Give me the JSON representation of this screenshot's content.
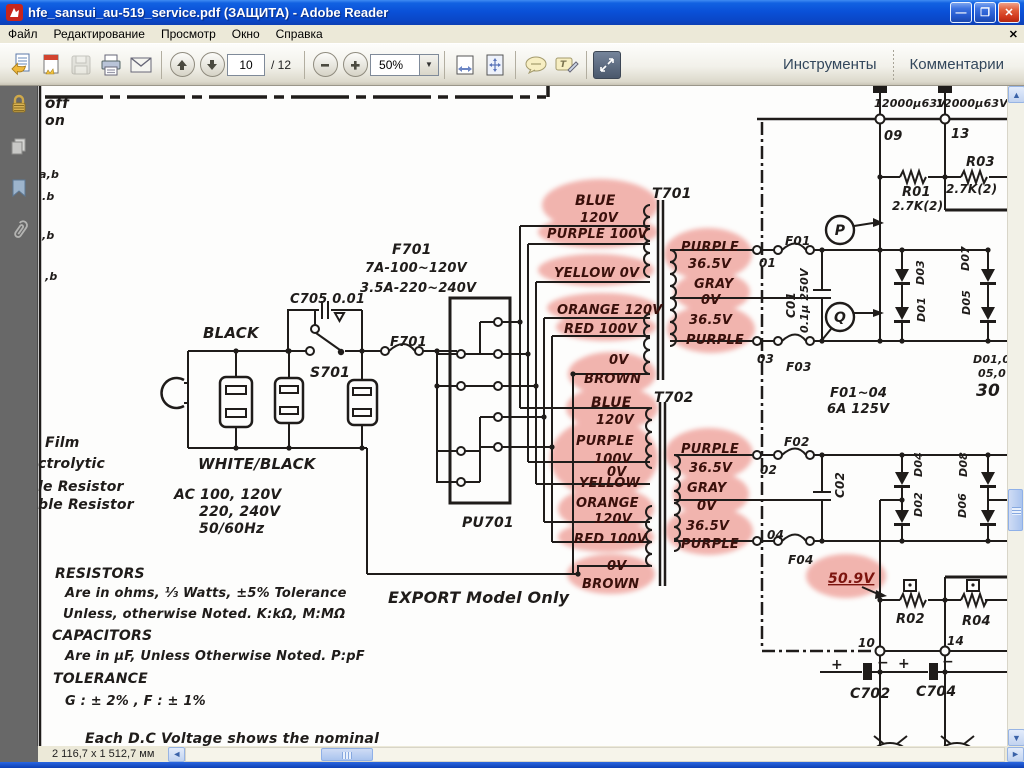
{
  "window": {
    "title": "hfe_sansui_au-519_service.pdf (ЗАЩИТА) - Adobe Reader",
    "minimize_glyph": "—",
    "restore_glyph": "❐",
    "close_glyph": "✕"
  },
  "menu": {
    "items": [
      "Файл",
      "Редактирование",
      "Просмотр",
      "Окно",
      "Справка"
    ],
    "close_glyph": "✕"
  },
  "toolbar": {
    "icons": [
      "open-file",
      "create-pdf",
      "save",
      "print",
      "email",
      "previous-page",
      "next-page",
      "zoom-out",
      "zoom-in",
      "fit-width",
      "fit-page",
      "comment-bubble",
      "text-callout",
      "fullscreen"
    ],
    "page_current": "10",
    "page_total": "/ 12",
    "zoom_value": "50%",
    "zoom_dropdown_glyph": "▼",
    "tools_label": "Инструменты",
    "comments_label": "Комментарии"
  },
  "sidebar": {
    "icons": [
      "lock",
      "pages",
      "bookmark",
      "paperclip"
    ]
  },
  "statusbar": {
    "doc_size": "2 116,7 x 1 512,7 мм",
    "left_glyph": "◄",
    "right_glyph": "►",
    "up_glyph": "▲",
    "down_glyph": "▼"
  },
  "schematic": {
    "highlight_color": "#efa29b",
    "labels": [
      {
        "t": "off",
        "x": 7,
        "y": 22,
        "s": 15
      },
      {
        "t": "on",
        "x": 7,
        "y": 39,
        "s": 14
      },
      {
        "t": "a,b",
        "x": 1,
        "y": 92,
        "s": 11
      },
      {
        "t": ".b",
        "x": 4,
        "y": 114,
        "s": 11
      },
      {
        "t": ",b",
        "x": 4,
        "y": 153,
        "s": 11
      },
      {
        "t": ",b",
        "x": 7,
        "y": 194,
        "s": 11
      },
      {
        "t": "BLACK",
        "x": 165,
        "y": 252,
        "s": 15
      },
      {
        "t": "C705 0.01",
        "x": 252,
        "y": 217,
        "s": 13
      },
      {
        "t": "S701",
        "x": 272,
        "y": 291,
        "s": 14
      },
      {
        "t": "F701",
        "x": 354,
        "y": 168,
        "s": 14
      },
      {
        "t": "7A-100~120V",
        "x": 327,
        "y": 186,
        "s": 13
      },
      {
        "t": "3.5A-220~240V",
        "x": 322,
        "y": 206,
        "s": 13
      },
      {
        "t": "F701",
        "x": 352,
        "y": 260,
        "s": 13
      },
      {
        "t": "PU701",
        "x": 424,
        "y": 441,
        "s": 14
      },
      {
        "t": "EXPORT Model Only",
        "x": 350,
        "y": 517,
        "s": 16
      },
      {
        "t": "WHITE/BLACK",
        "x": 160,
        "y": 383,
        "s": 15
      },
      {
        "t": "AC 100, 120V",
        "x": 136,
        "y": 413,
        "s": 14
      },
      {
        "t": "220, 240V",
        "x": 161,
        "y": 430,
        "s": 14
      },
      {
        "t": "50/60Hz",
        "x": 161,
        "y": 447,
        "s": 14
      },
      {
        "t": "T701",
        "x": 614,
        "y": 112,
        "s": 14
      },
      {
        "t": "T702",
        "x": 616,
        "y": 316,
        "s": 14
      },
      {
        "t": "12000μ63V",
        "x": 836,
        "y": 21,
        "s": 11
      },
      {
        "t": "12000μ63V",
        "x": 898,
        "y": 21,
        "s": 11
      },
      {
        "t": "09",
        "x": 846,
        "y": 54,
        "s": 13
      },
      {
        "t": "13",
        "x": 913,
        "y": 52,
        "s": 13
      },
      {
        "t": "R03",
        "x": 928,
        "y": 80,
        "s": 13
      },
      {
        "t": "2.7K(2)",
        "x": 908,
        "y": 107,
        "s": 12
      },
      {
        "t": "R01",
        "x": 864,
        "y": 110,
        "s": 13
      },
      {
        "t": "2.7K(2)",
        "x": 854,
        "y": 124,
        "s": 12
      },
      {
        "t": "P",
        "x": 802,
        "y": 149,
        "s": 14,
        "a": "middle"
      },
      {
        "t": "Q",
        "x": 802,
        "y": 236,
        "s": 14,
        "a": "middle"
      },
      {
        "t": "F01",
        "x": 747,
        "y": 159,
        "s": 12
      },
      {
        "t": "01",
        "x": 721,
        "y": 181,
        "s": 12
      },
      {
        "t": "C01",
        "x": 757,
        "y": 232,
        "s": 12,
        "r": -90
      },
      {
        "t": "0.1μ 250V",
        "x": 770,
        "y": 247,
        "s": 11,
        "r": -90
      },
      {
        "t": "03",
        "x": 719,
        "y": 277,
        "s": 12
      },
      {
        "t": "F03",
        "x": 748,
        "y": 285,
        "s": 12
      },
      {
        "t": "F01~04",
        "x": 792,
        "y": 311,
        "s": 13
      },
      {
        "t": "6A 125V",
        "x": 789,
        "y": 327,
        "s": 13
      },
      {
        "t": "D03",
        "x": 886,
        "y": 199,
        "s": 11,
        "r": -90
      },
      {
        "t": "D01",
        "x": 887,
        "y": 236,
        "s": 11,
        "r": -90
      },
      {
        "t": "D07",
        "x": 931,
        "y": 185,
        "s": 11,
        "r": -90
      },
      {
        "t": "D05",
        "x": 932,
        "y": 229,
        "s": 11,
        "r": -90
      },
      {
        "t": "D01,0",
        "x": 935,
        "y": 277,
        "s": 11
      },
      {
        "t": "05,0",
        "x": 940,
        "y": 291,
        "s": 11
      },
      {
        "t": "30",
        "x": 938,
        "y": 310,
        "s": 17
      },
      {
        "t": "F02",
        "x": 746,
        "y": 360,
        "s": 12
      },
      {
        "t": "02",
        "x": 722,
        "y": 388,
        "s": 12
      },
      {
        "t": "C02",
        "x": 806,
        "y": 412,
        "s": 12,
        "r": -90
      },
      {
        "t": "04",
        "x": 729,
        "y": 453,
        "s": 12
      },
      {
        "t": "F04",
        "x": 750,
        "y": 478,
        "s": 12
      },
      {
        "t": "R02",
        "x": 858,
        "y": 537,
        "s": 13
      },
      {
        "t": "R04",
        "x": 924,
        "y": 539,
        "s": 13
      },
      {
        "t": "10",
        "x": 820,
        "y": 561,
        "s": 12
      },
      {
        "t": "14",
        "x": 909,
        "y": 559,
        "s": 12
      },
      {
        "t": "+",
        "x": 793,
        "y": 583,
        "s": 14
      },
      {
        "t": "−",
        "x": 839,
        "y": 581,
        "s": 14
      },
      {
        "t": "+",
        "x": 860,
        "y": 582,
        "s": 14
      },
      {
        "t": "−",
        "x": 904,
        "y": 580,
        "s": 14
      },
      {
        "t": "C702",
        "x": 812,
        "y": 612,
        "s": 14
      },
      {
        "t": "C704",
        "x": 878,
        "y": 610,
        "s": 14
      },
      {
        "t": "D04",
        "x": 884,
        "y": 391,
        "s": 11,
        "r": -90
      },
      {
        "t": "D02",
        "x": 884,
        "y": 431,
        "s": 11,
        "r": -90
      },
      {
        "t": "D08",
        "x": 929,
        "y": 391,
        "s": 11,
        "r": -90
      },
      {
        "t": "D06",
        "x": 928,
        "y": 432,
        "s": 11,
        "r": -90
      },
      {
        "t": "Film",
        "x": 7,
        "y": 361,
        "s": 14
      },
      {
        "t": "ctrolytic",
        "x": 0,
        "y": 382,
        "s": 14
      },
      {
        "t": "le Resistor",
        "x": 0,
        "y": 405,
        "s": 14
      },
      {
        "t": "ble Resistor",
        "x": 0,
        "y": 423,
        "s": 14
      },
      {
        "t": "RESISTORS",
        "x": 17,
        "y": 492,
        "s": 14
      },
      {
        "t": "Are in ohms, ⅓ Watts, ±5% Tolerance",
        "x": 27,
        "y": 511,
        "s": 13
      },
      {
        "t": "Unless, otherwise Noted. K:kΩ, M:MΩ",
        "x": 25,
        "y": 532,
        "s": 13
      },
      {
        "t": "CAPACITORS",
        "x": 14,
        "y": 554,
        "s": 14
      },
      {
        "t": "Are in μF, Unless Otherwise Noted. P:pF",
        "x": 27,
        "y": 574,
        "s": 13
      },
      {
        "t": "TOLERANCE",
        "x": 15,
        "y": 597,
        "s": 14
      },
      {
        "t": "G : ± 2% , F : ± 1%",
        "x": 27,
        "y": 619,
        "s": 13
      },
      {
        "t": "Each D.C Voltage shows the nominal",
        "x": 47,
        "y": 657,
        "s": 14
      },
      {
        "t": "BLUE",
        "x": 537,
        "y": 119,
        "s": 14,
        "c": "hl"
      },
      {
        "t": "120V",
        "x": 542,
        "y": 136,
        "s": 13,
        "c": "hl"
      },
      {
        "t": "PURPLE 100V",
        "x": 509,
        "y": 152,
        "s": 13,
        "c": "hl"
      },
      {
        "t": "YELLOW 0V",
        "x": 516,
        "y": 191,
        "s": 13,
        "c": "hl"
      },
      {
        "t": "ORANGE 120V",
        "x": 519,
        "y": 228,
        "s": 13,
        "c": "hl"
      },
      {
        "t": "RED 100V",
        "x": 526,
        "y": 247,
        "s": 13,
        "c": "hl"
      },
      {
        "t": "0V",
        "x": 571,
        "y": 278,
        "s": 13,
        "c": "hl"
      },
      {
        "t": "BROWN",
        "x": 546,
        "y": 297,
        "s": 13,
        "c": "hl"
      },
      {
        "t": "PURPLE",
        "x": 643,
        "y": 165,
        "s": 13,
        "c": "hl"
      },
      {
        "t": "36.5V",
        "x": 650,
        "y": 182,
        "s": 13,
        "c": "hl"
      },
      {
        "t": "GRAY",
        "x": 656,
        "y": 202,
        "s": 13,
        "c": "hl"
      },
      {
        "t": "0V",
        "x": 663,
        "y": 218,
        "s": 13,
        "c": "hl"
      },
      {
        "t": "36.5V",
        "x": 651,
        "y": 238,
        "s": 13,
        "c": "hl"
      },
      {
        "t": "PURPLE",
        "x": 648,
        "y": 258,
        "s": 13,
        "c": "hl"
      },
      {
        "t": "BLUE",
        "x": 553,
        "y": 321,
        "s": 14,
        "c": "hl"
      },
      {
        "t": "120V",
        "x": 558,
        "y": 338,
        "s": 13,
        "c": "hl"
      },
      {
        "t": "PURPLE",
        "x": 538,
        "y": 359,
        "s": 13,
        "c": "hl"
      },
      {
        "t": "100V",
        "x": 556,
        "y": 377,
        "s": 13,
        "c": "hl"
      },
      {
        "t": "0V",
        "x": 569,
        "y": 390,
        "s": 13,
        "c": "hl"
      },
      {
        "t": "YELLOW",
        "x": 541,
        "y": 401,
        "s": 13,
        "c": "hl"
      },
      {
        "t": "ORANGE",
        "x": 538,
        "y": 421,
        "s": 13,
        "c": "hl"
      },
      {
        "t": "120V",
        "x": 556,
        "y": 437,
        "s": 13,
        "c": "hl"
      },
      {
        "t": "RED 100V",
        "x": 536,
        "y": 457,
        "s": 13,
        "c": "hl"
      },
      {
        "t": "0V",
        "x": 569,
        "y": 484,
        "s": 13,
        "c": "hl"
      },
      {
        "t": "BROWN",
        "x": 544,
        "y": 502,
        "s": 13,
        "c": "hl"
      },
      {
        "t": "PURPLE",
        "x": 643,
        "y": 367,
        "s": 13,
        "c": "hl"
      },
      {
        "t": "36.5V",
        "x": 651,
        "y": 386,
        "s": 13,
        "c": "hl"
      },
      {
        "t": "GRAY",
        "x": 649,
        "y": 406,
        "s": 13,
        "c": "hl"
      },
      {
        "t": "0V",
        "x": 659,
        "y": 424,
        "s": 13,
        "c": "hl"
      },
      {
        "t": "36.5V",
        "x": 648,
        "y": 444,
        "s": 13,
        "c": "hl"
      },
      {
        "t": "PURPLE",
        "x": 643,
        "y": 462,
        "s": 13,
        "c": "hl"
      },
      {
        "t": "50.9V",
        "x": 790,
        "y": 497,
        "s": 14,
        "c": "red"
      }
    ]
  }
}
